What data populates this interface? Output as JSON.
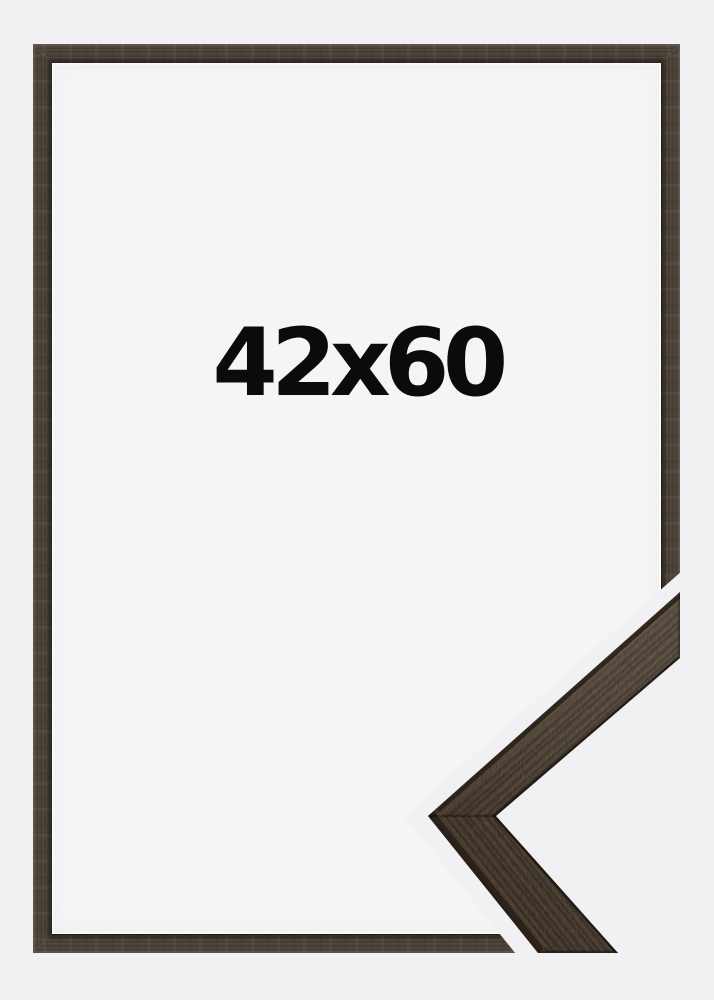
{
  "page": {
    "label": "42x60"
  },
  "colors": {
    "background": "#f1f1f3",
    "inner": "#f5f5f6",
    "label_text": "#0b0b0b",
    "frame_wood": "#4a4036",
    "frame_wood_dark": "#231c15",
    "frame_wood_light": "#6b6156",
    "detail_wood": "#56483a",
    "detail_dark": "#2c2318",
    "detail_light": "#86715c"
  }
}
